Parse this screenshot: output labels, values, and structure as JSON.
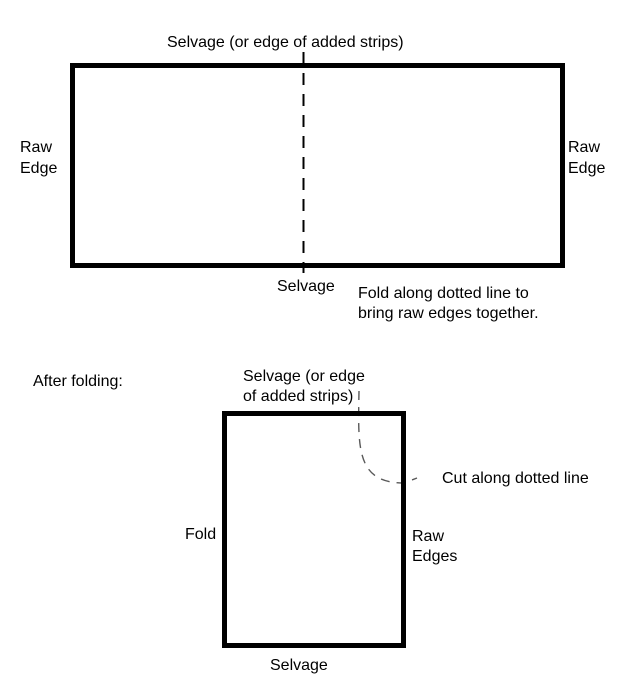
{
  "colors": {
    "background": "#ffffff",
    "rectangle_border": "#000000",
    "fold_dash_line": "#000000",
    "cut_dash_line": "#595959",
    "text": "#000000"
  },
  "before_folding": {
    "top_label": "Selvage (or edge of added strips)",
    "left_label": "Raw\nEdge",
    "right_label": "Raw\nEdge",
    "bottom_label": "Selvage",
    "instruction": "Fold along dotted line to\nbring raw edges together."
  },
  "after_folding": {
    "heading": "After folding:",
    "top_label": "Selvage (or edge\nof added strips)",
    "left_label": "Fold",
    "right_label": "Raw\nEdges",
    "cut_label": "Cut along dotted line",
    "bottom_label": "Selvage"
  }
}
